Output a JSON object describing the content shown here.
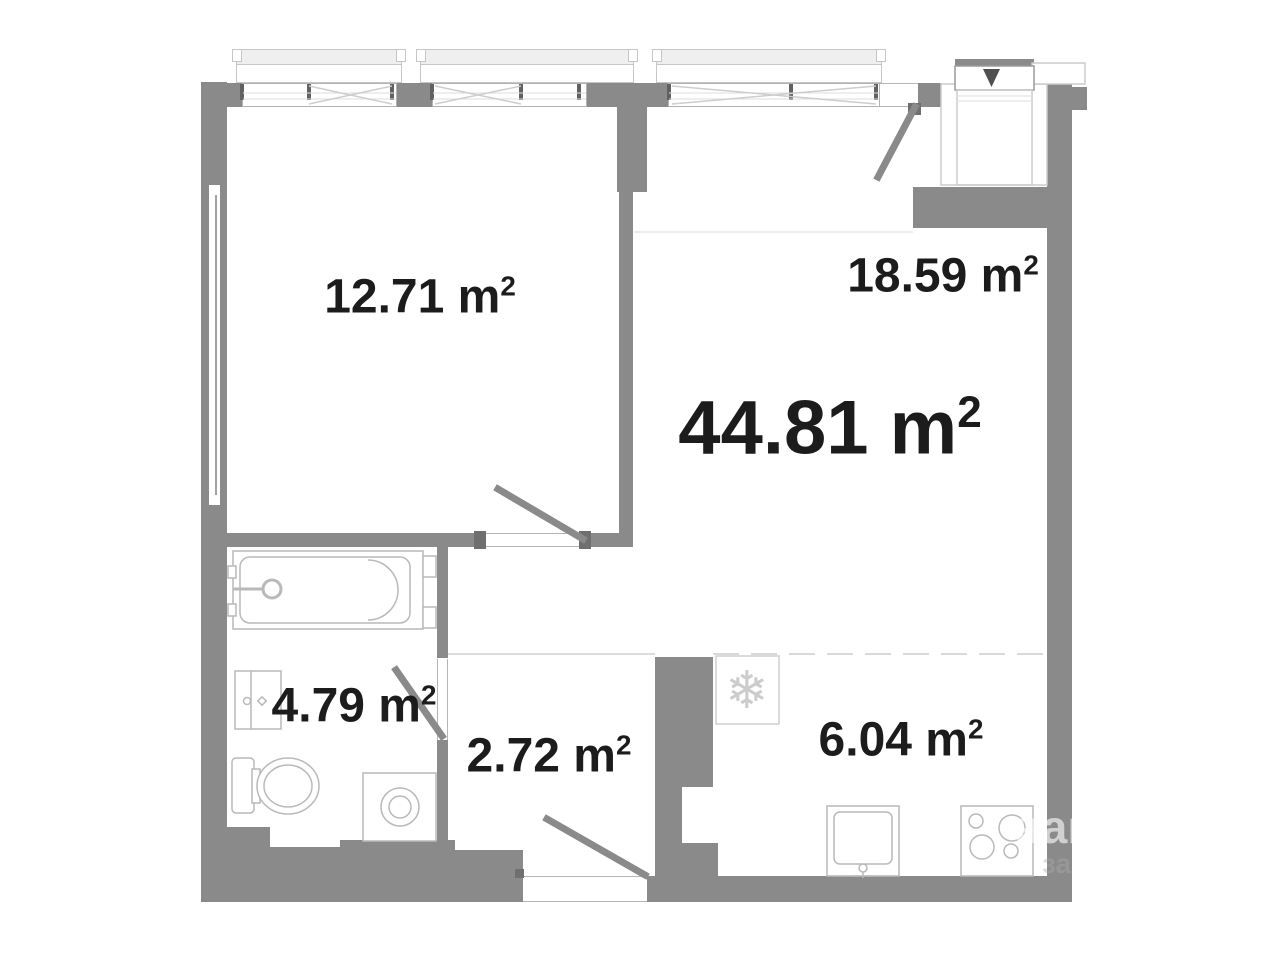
{
  "plan_title": "apartment floor plan",
  "rooms": {
    "living_total": {
      "text": "44.81 m",
      "sup": "2"
    },
    "bedroom": {
      "text": "12.71 m",
      "sup": "2"
    },
    "living": {
      "text": "18.59 m",
      "sup": "2"
    },
    "bathroom": {
      "text": "4.79 m",
      "sup": "2"
    },
    "hallway": {
      "text": "2.72 m",
      "sup": "2"
    },
    "kitchen": {
      "text": "6.04 m",
      "sup": "2"
    }
  },
  "icons": {
    "fridge_snowflake": "❄"
  },
  "watermark": {
    "fragment_on_wall": "нап",
    "fragment_below": "за"
  },
  "colors": {
    "wall": "#8a8a8a",
    "fixture_line": "#b9b9b9",
    "text": "#1c1c1c"
  }
}
